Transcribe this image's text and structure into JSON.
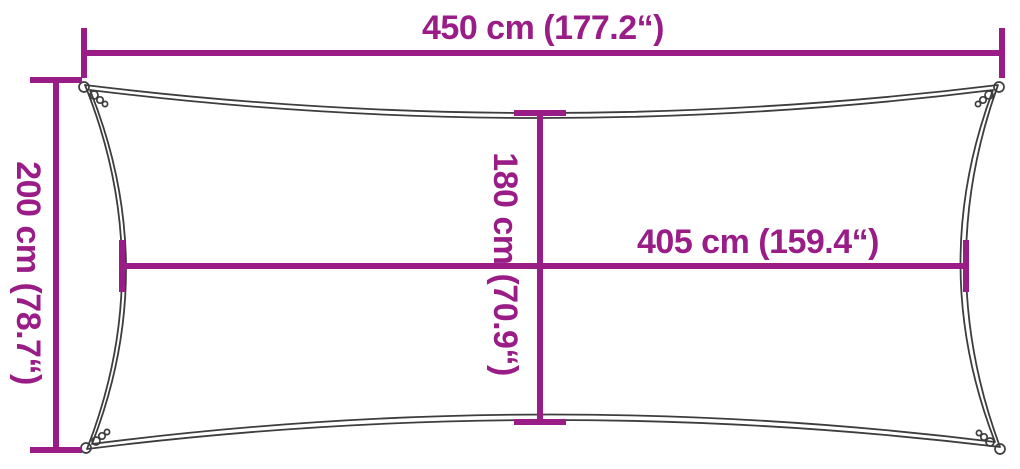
{
  "diagram": {
    "colors": {
      "accent": "#9A1C87",
      "outline": "#3D3D3D",
      "background": "#FFFFFF"
    },
    "labels": {
      "top_width": "450 cm (177.2“)",
      "left_height": "200 cm (78.7“)",
      "center_height": "180 cm (70.9“)",
      "center_width": "405 cm (159.4“)"
    }
  }
}
